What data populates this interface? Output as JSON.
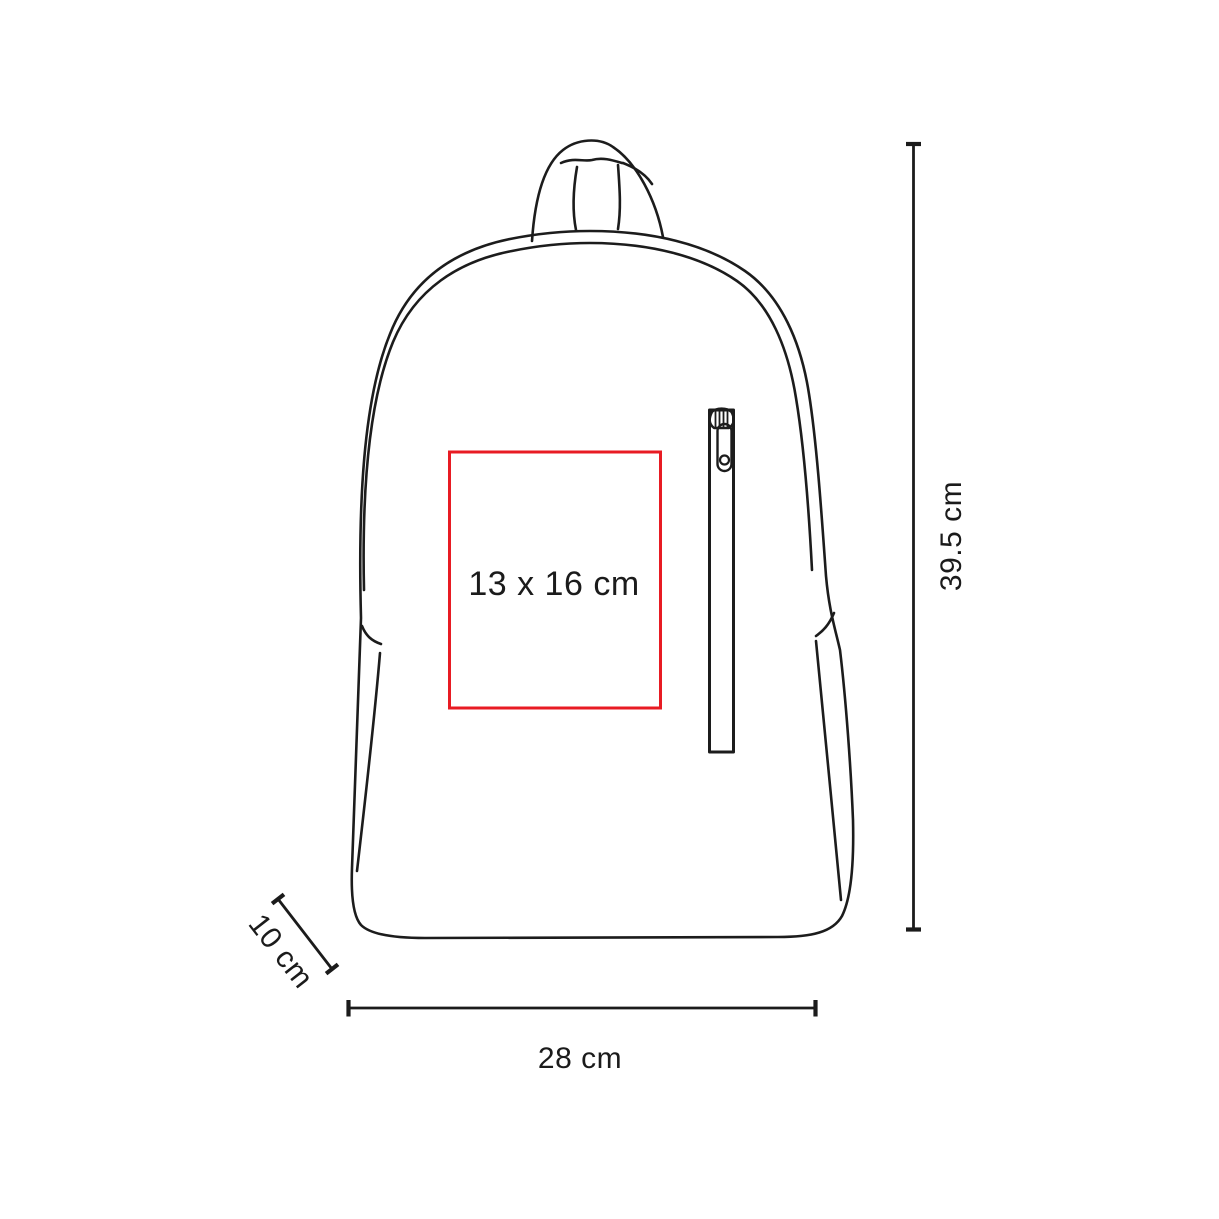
{
  "diagram": {
    "product": "backpack",
    "view": "front-line-drawing",
    "print_area": {
      "label": "13 x 16 cm"
    },
    "dimensions": {
      "height": {
        "label": "39.5 cm"
      },
      "width": {
        "label": "28 cm"
      },
      "depth": {
        "label": "10 cm"
      }
    },
    "colors": {
      "line": "#1c1c1c",
      "print_area_border": "#e81b23",
      "text": "#1b1b1b",
      "background": "#ffffff"
    }
  }
}
